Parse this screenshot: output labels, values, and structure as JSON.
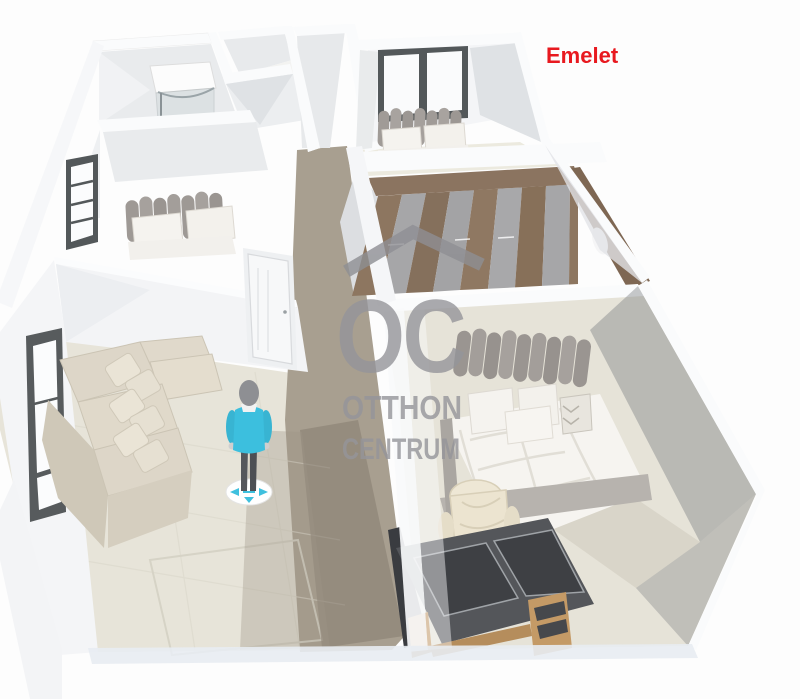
{
  "floor_label": {
    "text": "Emelet",
    "color": "#e8191f"
  },
  "watermark": {
    "monogram": "OC",
    "name_line1": "OTTHON",
    "name_line2": "CENTRUM",
    "color": "#95959a",
    "roof_icon": "roof-chevron-icon"
  },
  "palette": {
    "background": "#fdfdfd",
    "wall_white": "#f8f9fb",
    "wall_shade": "#e8eaec",
    "wall_dark": "#d8dbde",
    "floor_room_beige": "#e6e3d8",
    "floor_hall_taupe": "#a89f90",
    "hall_shadow": "#8f8678",
    "wardrobe_wood": "#8b7460",
    "wardrobe_panel_gray": "#a6a6a8",
    "sofa_beige": "#ddd6c8",
    "headboard_gray": "#9a9591",
    "linen_white": "#f5f3ef",
    "desk_top_dark": "#46484c",
    "desk_oak": "#c49a66",
    "chair_cream": "#eee7d5",
    "window_frame_dark": "#53585a",
    "avatar_shirt_cyan": "#3cbfde",
    "avatar_pants": "#55575c",
    "puck_arrow_cyan": "#3fc0de"
  },
  "scene": {
    "view": "3d-dollhouse-floorplan",
    "rooms": [
      {
        "name": "bathroom",
        "fixtures": [
          "corner-shower"
        ]
      },
      {
        "name": "bedroom-left",
        "furniture": [
          "double-bed"
        ],
        "openings": [
          "window",
          "door"
        ]
      },
      {
        "name": "hallway",
        "floor": "taupe-tile"
      },
      {
        "name": "bedroom-top",
        "furniture": [
          "double-bed"
        ],
        "openings": [
          "window"
        ]
      },
      {
        "name": "walk-in-closet",
        "furniture": [
          "wardrobe-wood-panels"
        ]
      },
      {
        "name": "bedroom-right",
        "furniture": [
          "double-bed",
          "office-chair",
          "dark-desk"
        ]
      },
      {
        "name": "living-room",
        "furniture": [
          "corner-sofa"
        ],
        "openings": [
          "window"
        ]
      }
    ],
    "avatar": {
      "type": "person",
      "shirt": "cyan",
      "control": "move-puck"
    }
  }
}
